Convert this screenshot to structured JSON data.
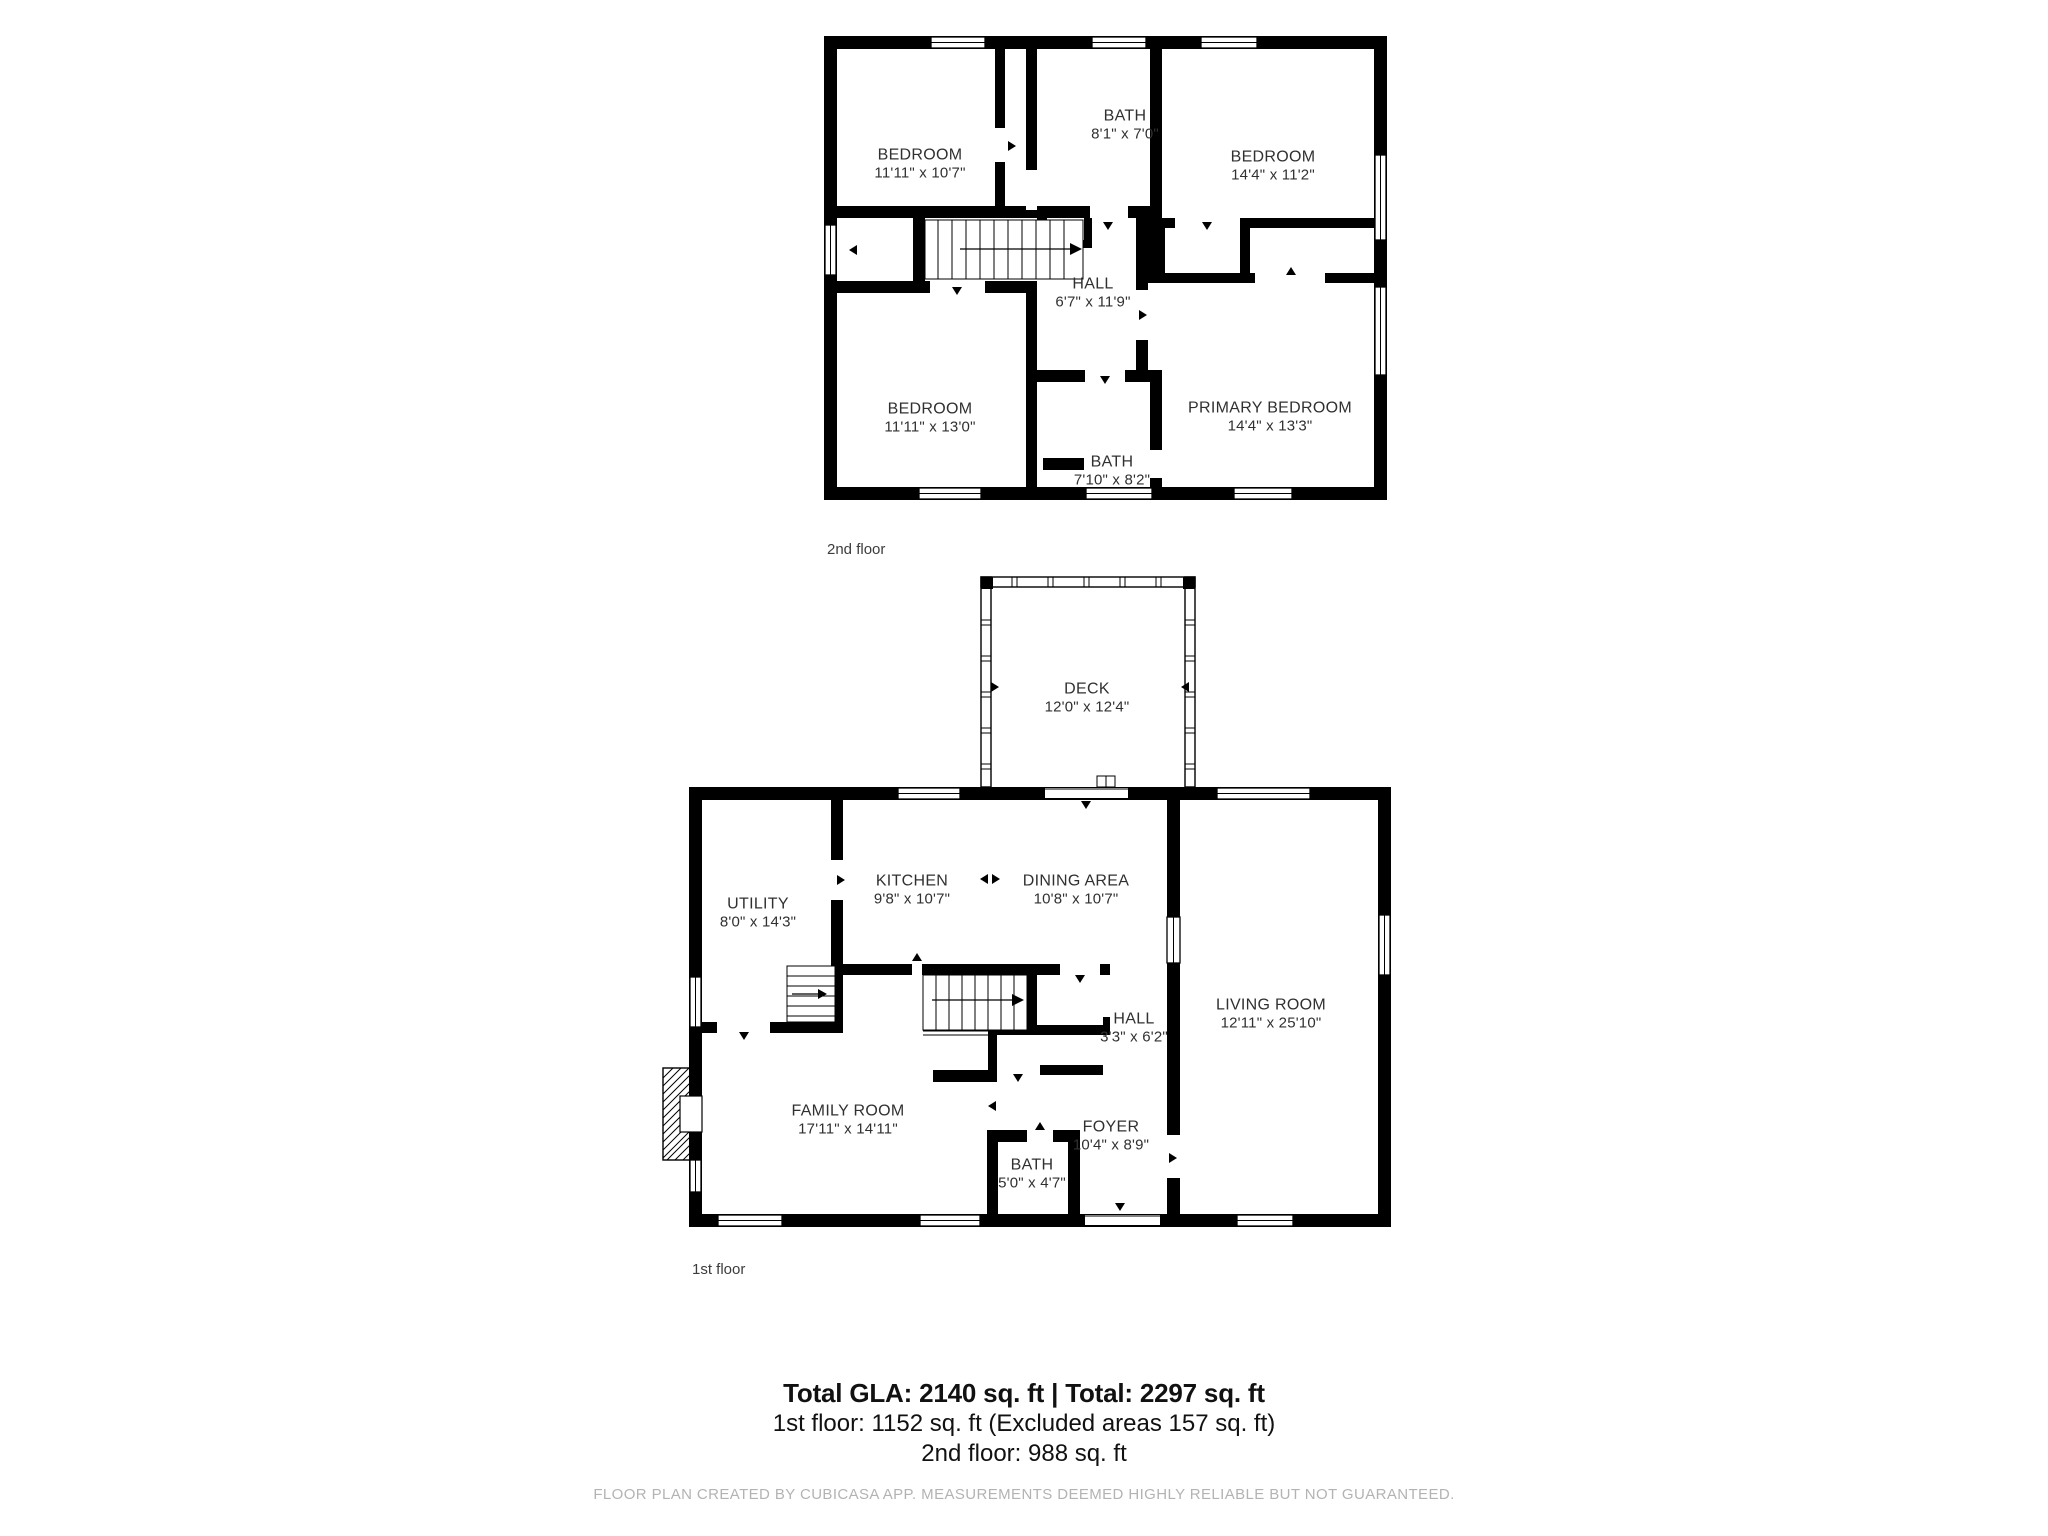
{
  "colors": {
    "wall": "#000000",
    "room_text": "#303030",
    "caption_text": "#3c3c3c",
    "disclaimer_text": "#b3b3b3"
  },
  "floors": [
    {
      "caption": "2nd floor",
      "rooms": [
        {
          "id": "bedroom-top-left",
          "name": "BEDROOM",
          "dims": "11'11\" x 10'7\""
        },
        {
          "id": "bath-top",
          "name": "BATH",
          "dims": "8'1\" x 7'0\""
        },
        {
          "id": "bedroom-top-right",
          "name": "BEDROOM",
          "dims": "14'4\" x 11'2\""
        },
        {
          "id": "hall-2f",
          "name": "HALL",
          "dims": "6'7\" x 11'9\""
        },
        {
          "id": "bedroom-bottom-left",
          "name": "BEDROOM",
          "dims": "11'11\" x 13'0\""
        },
        {
          "id": "bath-bottom",
          "name": "BATH",
          "dims": "7'10\" x 8'2\""
        },
        {
          "id": "primary-bedroom",
          "name": "PRIMARY BEDROOM",
          "dims": "14'4\" x 13'3\""
        }
      ]
    },
    {
      "caption": "1st floor",
      "rooms": [
        {
          "id": "deck",
          "name": "DECK",
          "dims": "12'0\" x 12'4\""
        },
        {
          "id": "utility",
          "name": "UTILITY",
          "dims": "8'0\" x 14'3\""
        },
        {
          "id": "kitchen",
          "name": "KITCHEN",
          "dims": "9'8\" x 10'7\""
        },
        {
          "id": "dining-area",
          "name": "DINING AREA",
          "dims": "10'8\" x 10'7\""
        },
        {
          "id": "living-room",
          "name": "LIVING ROOM",
          "dims": "12'11\" x 25'10\""
        },
        {
          "id": "hall-1f",
          "name": "HALL",
          "dims": "3'3\" x 6'2\""
        },
        {
          "id": "family-room",
          "name": "FAMILY ROOM",
          "dims": "17'11\" x 14'11\""
        },
        {
          "id": "foyer",
          "name": "FOYER",
          "dims": "10'4\" x 8'9\""
        },
        {
          "id": "bath-1f",
          "name": "BATH",
          "dims": "5'0\" x 4'7\""
        }
      ]
    }
  ],
  "summary": {
    "total_line": "Total GLA: 2140 sq. ft | Total: 2297 sq. ft",
    "first_floor_line": "1st floor: 1152 sq. ft (Excluded areas 157 sq. ft)",
    "second_floor_line": "2nd floor: 988 sq. ft"
  },
  "disclaimer": "FLOOR PLAN CREATED BY CUBICASA APP. MEASUREMENTS DEEMED HIGHLY RELIABLE BUT NOT GUARANTEED."
}
